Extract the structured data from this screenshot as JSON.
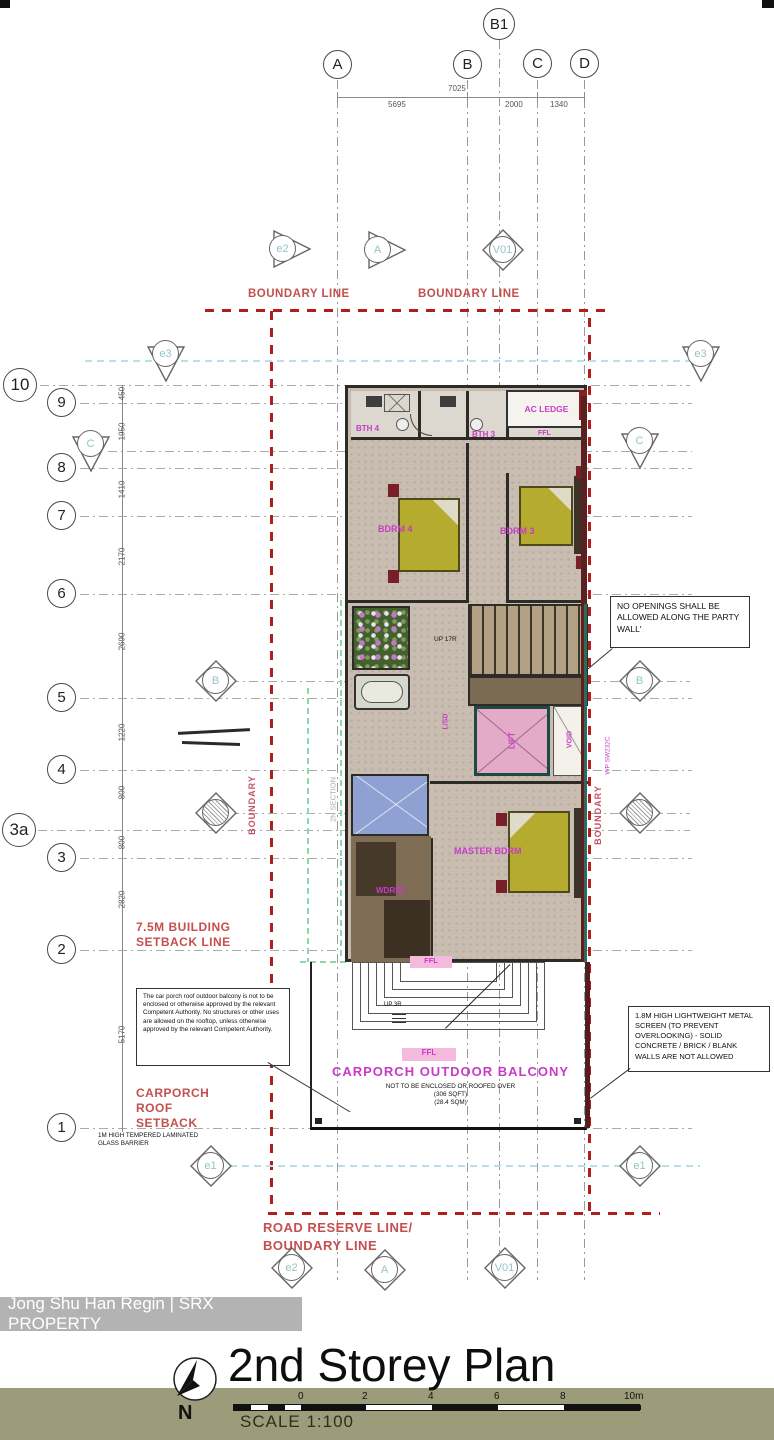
{
  "watermark": {
    "text": "Jong Shu Han Regin | SRX PROPERTY"
  },
  "title_block": {
    "title": "2nd Storey Plan",
    "scale_label": "SCALE 1:100",
    "north_label": "N",
    "scale_ticks": [
      "0",
      "2",
      "4",
      "6",
      "8",
      "10m"
    ]
  },
  "grid": {
    "b1": "B1",
    "columns": [
      "A",
      "B",
      "C",
      "D"
    ],
    "rows": [
      "10",
      "9",
      "8",
      "7",
      "6",
      "5",
      "4",
      "3a",
      "3",
      "2",
      "1"
    ],
    "top_dims": [
      "7025",
      "5695",
      "2000",
      "1340"
    ],
    "left_dims": [
      "450",
      "1950",
      "1410",
      "2170",
      "2690",
      "1220",
      "800",
      "800",
      "2820",
      "5170"
    ]
  },
  "markers": {
    "e1": "e1",
    "e2": "e2",
    "e3": "e3",
    "a": "A",
    "b": "B",
    "c": "C",
    "v": "V01"
  },
  "boundary": {
    "boundary_line": "BOUNDARY LINE",
    "boundary_line_2": "BOUNDARY LINE",
    "road_reserve": "ROAD RESERVE LINE/",
    "road_boundary": "BOUNDARY LINE",
    "building_setback": "7.5M BUILDING SETBACK LINE",
    "carporch_setback": "CARPORCH ROOF SETBACK",
    "boundary_vertical": "BOUNDARY"
  },
  "rooms": {
    "bth4": "BTH 4",
    "bth3": "BTH 3",
    "ac_ledge": "AC LEDGE",
    "bdrm4": "BDRM 4",
    "bdrm3": "BDRM 3",
    "master": "MASTER BDRM",
    "wardrobe": "WDRBE",
    "lift": "LIFT",
    "void": "VOID",
    "hall": "L/SD",
    "balcony": "CARPORCH OUTDOOR BALCONY",
    "ffl": "FFL"
  },
  "plan_texts": {
    "up17": "UP 17R",
    "up3": "UP 3R",
    "wp": "WP SW232C",
    "section_line": "2N SECTION",
    "balcony_note_1": "NOT TO BE ENCLOSED OR ROOFED OVER",
    "balcony_note_2": "(306 SQFT)",
    "balcony_note_3": "(28.4 SQM)"
  },
  "notes": {
    "party_wall": "NO OPENINGS SHALL BE ALLOWED ALONG THE PARTY WALL'",
    "screen": "1.8M HIGH LIGHTWEIGHT METAL SCREEN (TO PREVENT OVERLOOKING) - SOLID CONCRETE / BRICK / BLANK WALLS ARE NOT ALLOWED",
    "carporch": "The car porch roof outdoor balcony is not to be enclosed or otherwise approved by the relevant Competent Authority. No structures or other uses are allowed on the rooftop, unless otherwise approved by the relevant Competent Authority.",
    "glass_barrier": "1M HIGH TEMPERED LAMINATED GLASS BARRIER"
  },
  "colors": {
    "boundary_red": "#b01e1e",
    "annotation_red": "#c4504e",
    "room_magenta": "#c73bc7",
    "marker_teal": "#92c4c6",
    "bed_yellow": "#b4ab2f",
    "olive_band": "#9c9c7a"
  }
}
